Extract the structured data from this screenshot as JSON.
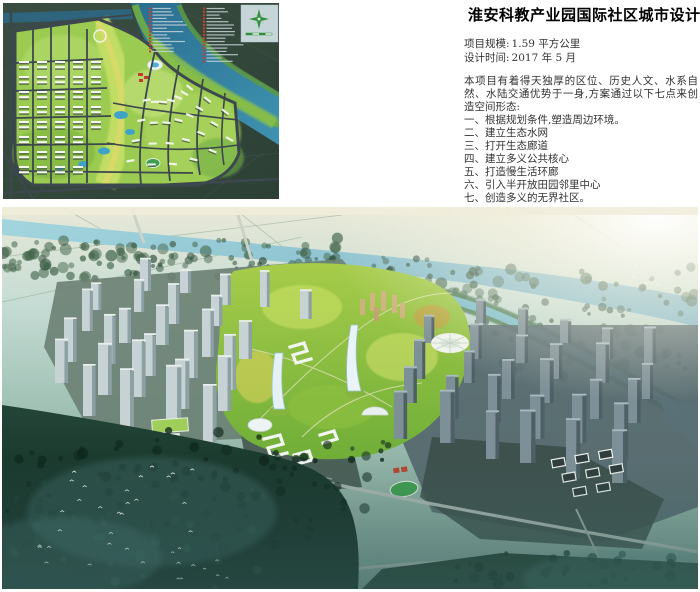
{
  "page": {
    "title": "淮安科教产业园国际社区城市设计",
    "meta": [
      {
        "label": "项目规模:",
        "value": "1.59 平方公里"
      },
      {
        "label": "设计时间:",
        "value": "2017 年 5 月"
      }
    ],
    "intro": "本项目有着得天独厚的区位、历史人文、水系自然、水陆交通优势于一身,方案通过以下七点来创造空间形态:",
    "points": [
      "一、根据规划条件,塑造周边环境。",
      "二、建立生态水网",
      "三、打开生态廊道",
      "四、建立多义公共核心",
      "五、打造慢生活环廊",
      "六、引入半开放田园邻里中心",
      "七、创造多义的无界社区。"
    ]
  },
  "masterplan": {
    "legend": {
      "column1_rows": 14,
      "column2_rows": 17,
      "marker_color": "#d23a2c"
    },
    "compass": "north-arrow",
    "colors": {
      "site_green": "#8fc24a",
      "river_blue": "#2e7ba0",
      "road_dark": "#3d474e"
    }
  },
  "rendering": {
    "colors": {
      "water": "#8fc6d2",
      "park_green": "#9cc248",
      "tower_gray": "#c6d2d3",
      "sun_glow": "#f6f2e2"
    }
  }
}
